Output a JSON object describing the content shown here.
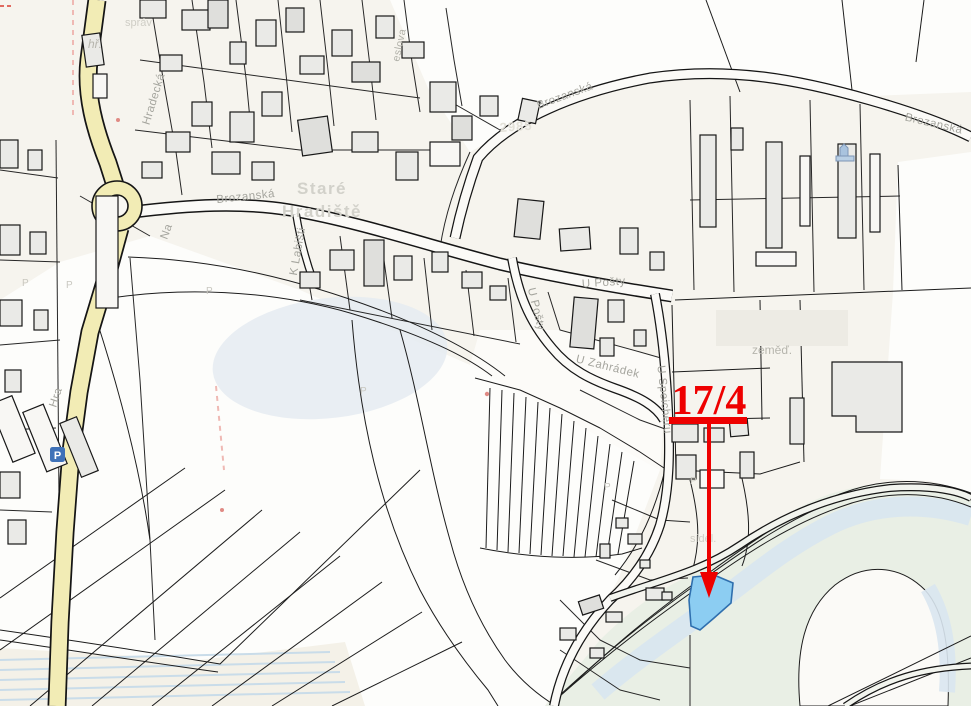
{
  "map": {
    "place": {
      "line1": "Staré",
      "line2": "Hradiště"
    },
    "streets": {
      "hradecka": "Hradecká",
      "hradecka_partial": "Hra",
      "brozanska": "Brozanská",
      "u_posty": "U Pošty",
      "u_zahradek": "U Zahrádek",
      "k_labisti": "K Labišti",
      "u_speicheru": "U Speicheru",
      "na_partial": "Na",
      "eslova_partial": "eslova"
    },
    "labels": {
      "hr": "hř.",
      "sprav": "správ",
      "zemed": "zeměď.",
      "sidel": "sídel.",
      "road_number": "2985",
      "parcel_marker": "P"
    },
    "annotation": {
      "parcel_number": "17/4"
    },
    "icons": {
      "parking": "P"
    },
    "colors": {
      "road_yellow": "#f2ecb5",
      "annotation_red": "#ee0000",
      "highlight_fill": "#8ccdf2",
      "highlight_stroke": "#2f6fae",
      "water": "#d9e6ef",
      "bank_green": "#e9efe5",
      "pond": "#e5ebf1",
      "building_fill": "#eaeae7",
      "background_beige": "#f6f4ee"
    }
  }
}
